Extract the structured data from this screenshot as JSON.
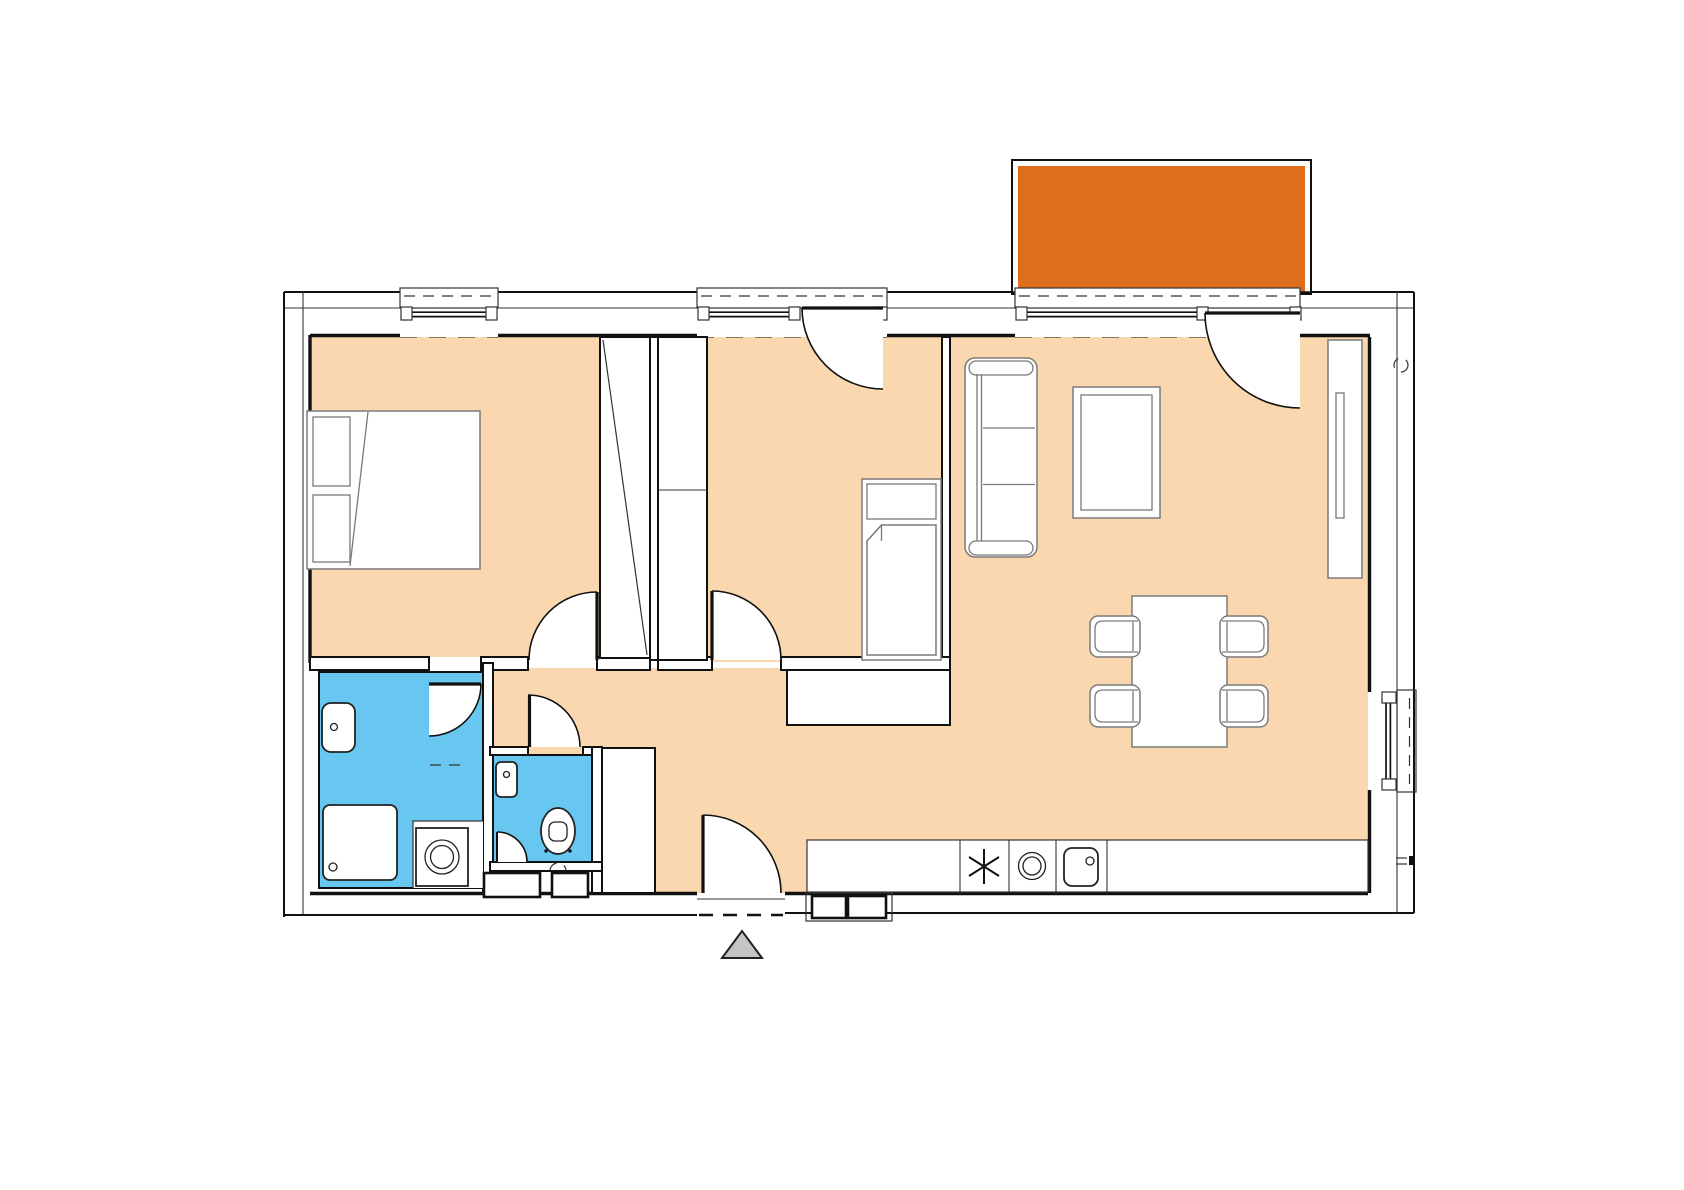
{
  "document": {
    "kind": "apartment-floor-plan"
  },
  "colors": {
    "background": "#ffffff",
    "floor": "#FAD7AE",
    "balcony": "#DD6E1C",
    "wet_room": "#68C7F0",
    "entrance_marker": "#C4C4C4",
    "wall_line": "#111111",
    "furniture_line": "#7a7a7a"
  },
  "symbols": {
    "stove_symbol": "✳",
    "entrance_arrow": "▲"
  }
}
